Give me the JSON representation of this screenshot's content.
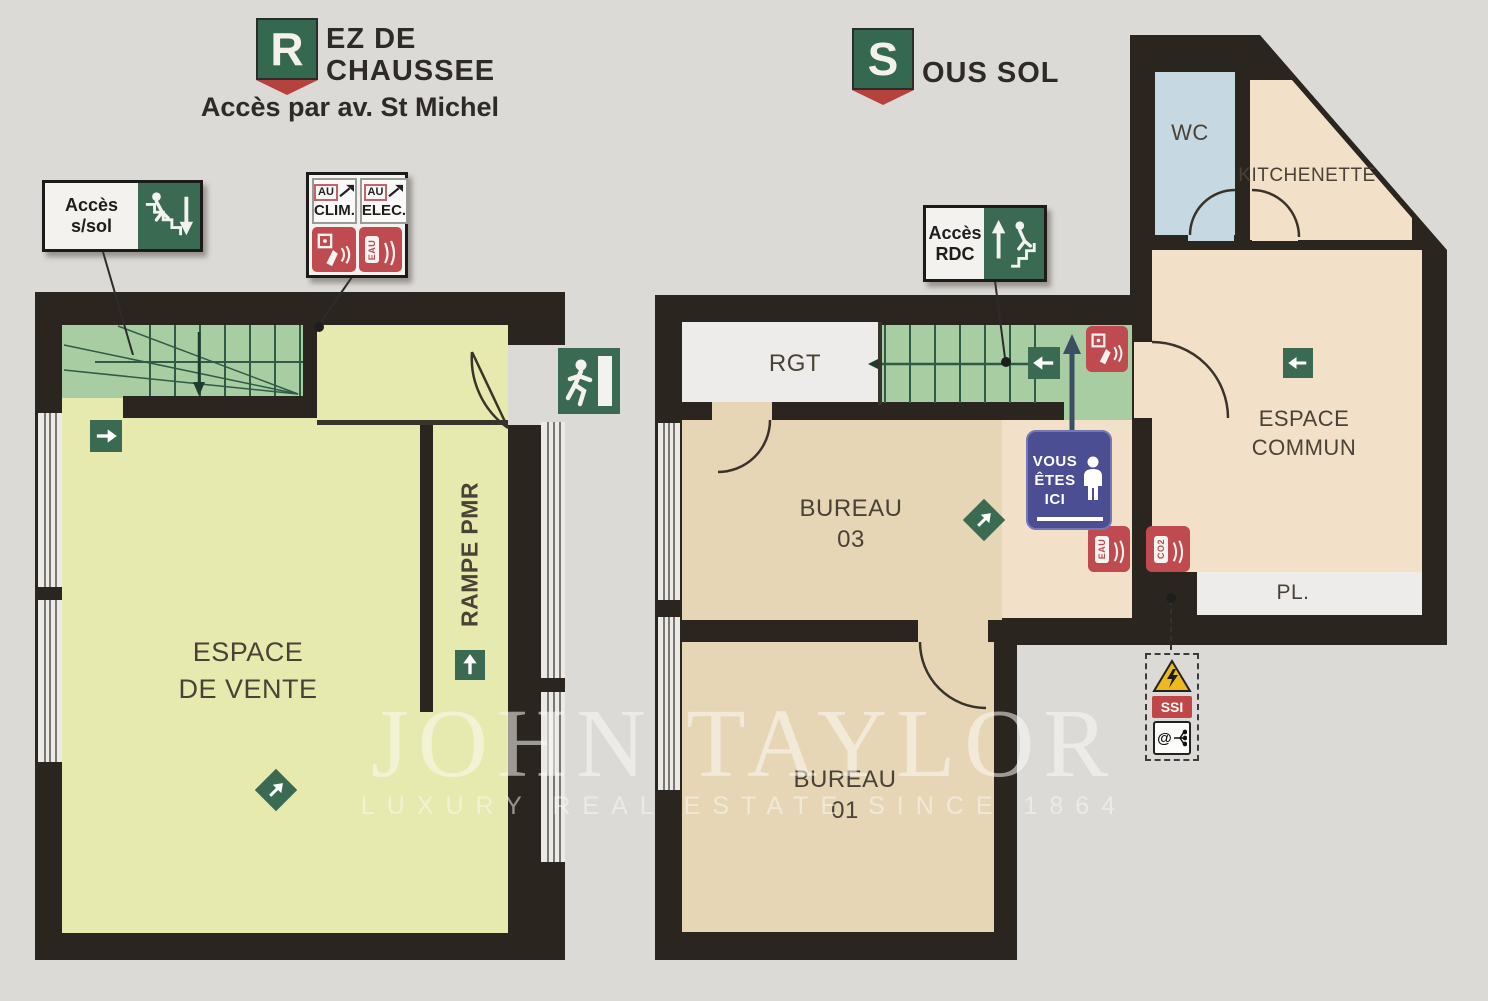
{
  "palette": {
    "background": "#dcdad7",
    "wall": "#2b2520",
    "ground_floor_room": "#e7eaae",
    "stairs_green": "#a8cda2",
    "office_tan": "#e6d6b6",
    "common_peach": "#f3e0c8",
    "wc_blue": "#c6d8e2",
    "white_room": "#edecea",
    "sign_green": "#3b6a53",
    "sign_red": "#bf4a50",
    "you_are_here_blue": "#4b4e93",
    "warning_yellow": "#edb91f"
  },
  "titles": {
    "ground": {
      "logo_letter": "R",
      "line1": "EZ DE",
      "line2": "CHAUSSEE",
      "access": "Accès par av. St Michel"
    },
    "basement": {
      "logo_letter": "S",
      "line1": "OUS SOL"
    }
  },
  "ground_floor": {
    "rooms": {
      "sales_line1": "ESPACE",
      "sales_line2": "DE VENTE",
      "ramp": "RAMPE PMR"
    },
    "signs": {
      "access_basement": {
        "line1": "Accès",
        "line2": "s/sol"
      },
      "shutoffs": {
        "clim_tag": "AU",
        "clim": "CLIM.",
        "elec_tag": "AU",
        "elec": "ELEC.",
        "extinguisher": "EAU"
      }
    }
  },
  "basement": {
    "rooms": {
      "storage": "RGT",
      "office3_line1": "BUREAU",
      "office3_line2": "03",
      "office1_line1": "BUREAU",
      "office1_line2": "01",
      "wc": "WC",
      "kitchenette": "KITCHENETTE",
      "common_line1": "ESPACE",
      "common_line2": "COMMUN",
      "closet": "PL."
    },
    "signs": {
      "access_ground": {
        "line1": "Accès",
        "line2": "RDC"
      },
      "you_are_here": {
        "line1": "VOUS",
        "line2": "ÊTES",
        "line3": "ICI"
      },
      "extinguisher_water": "EAU",
      "extinguisher_co2": "CO2",
      "ssi": "SSI",
      "at_symbol": "@"
    }
  },
  "watermark": {
    "brand": "JOHN TAYLOR",
    "tagline": "LUXURY REAL ESTATE SINCE 1864"
  },
  "icons": [
    "stairs-down-icon",
    "stairs-up-icon",
    "exit-running-man-icon",
    "arrow-right-icon",
    "arrow-up-icon",
    "arrow-left-icon",
    "arrow-ne-diamond-icon",
    "fire-alarm-push-button-icon",
    "fire-extinguisher-icon",
    "person-icon",
    "warning-triangle-icon",
    "network-icon",
    "electric-hazard-icon"
  ]
}
